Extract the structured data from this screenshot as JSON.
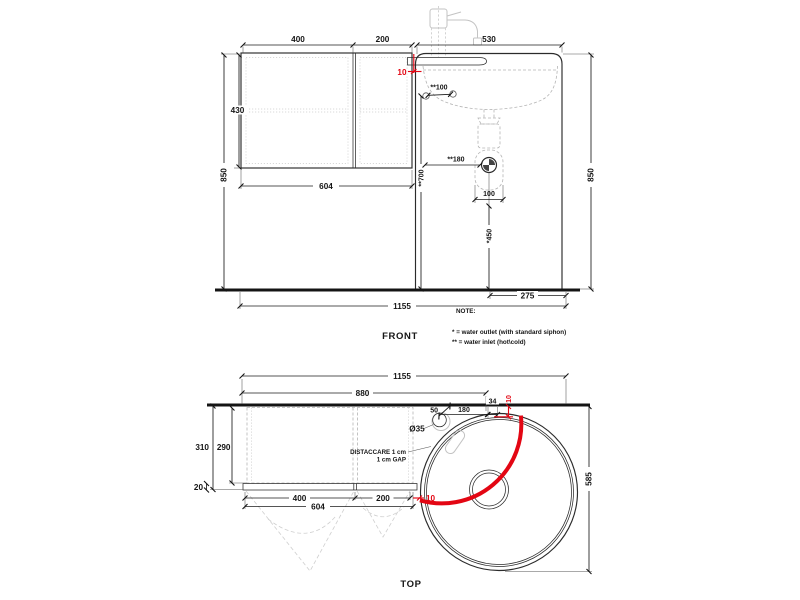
{
  "drawing": {
    "front": {
      "label": "FRONT",
      "dims": {
        "w_left_door": "400",
        "w_right_door": "200",
        "w_sink": "530",
        "h_cabinet": "430",
        "h_total_left": "850",
        "h_total_right": "850",
        "w_cabinet": "604",
        "gap": "10",
        "inlet_spacing": "**100",
        "inlet_height": "**700",
        "outlet_offset": "**180",
        "drain_spacing": "100",
        "outlet_height": "*450",
        "drain_to_edge": "275",
        "w_total": "1155"
      },
      "note": {
        "title": "NOTE:",
        "line1": "* = water outlet (with standard siphon)",
        "line2": "** = water inlet (hot\\cold)"
      }
    },
    "top": {
      "label": "TOP",
      "dims": {
        "w_total": "1155",
        "w_to_gap": "880",
        "faucet_offset": "50",
        "faucet_to_wall": "180",
        "wall_gap": "34",
        "gap_top": "10",
        "faucet_hole": "Ø35",
        "d_total": "310",
        "d_cabinet": "290",
        "d_door": "20",
        "w_left_door": "400",
        "w_right_door": "200",
        "w_cabinet": "604",
        "gap_bottom": "10",
        "d_sink": "585",
        "gap_note1": "DISTACCARE 1 cm",
        "gap_note2": "1 cm GAP"
      }
    }
  }
}
